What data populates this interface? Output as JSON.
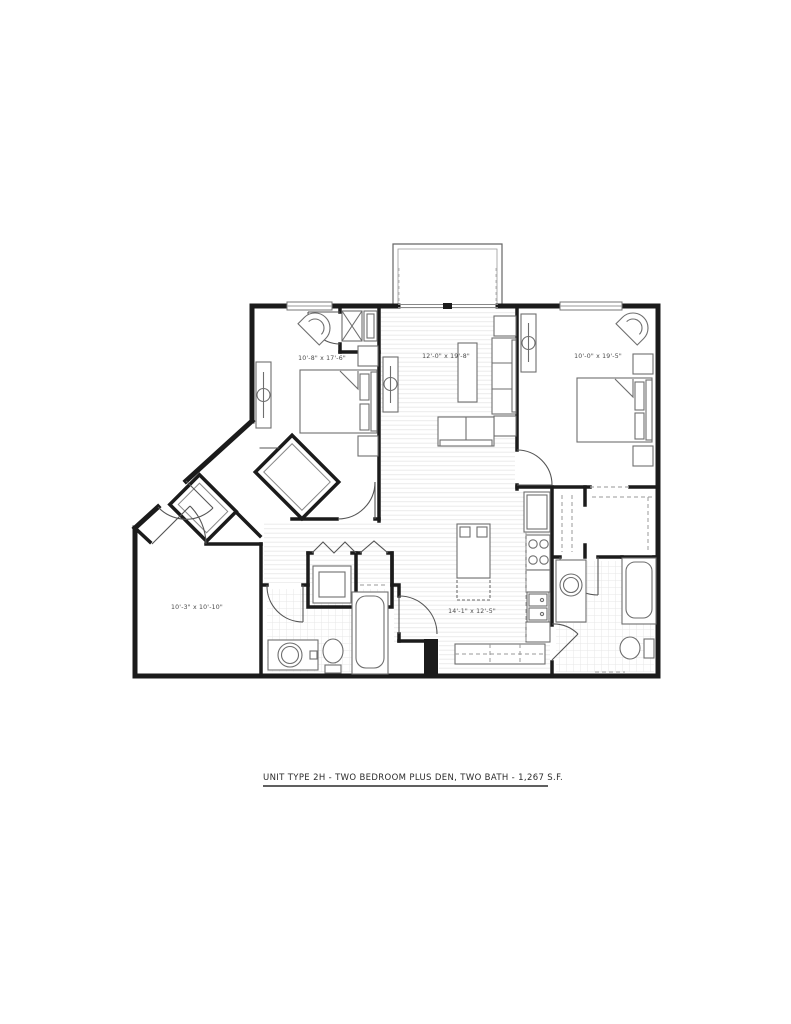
{
  "title": {
    "text": "UNIT TYPE 2H - TWO BEDROOM PLUS DEN, TWO BATH - 1,267 S.F."
  },
  "rooms": {
    "bedroom1": {
      "name": "bedroom-1",
      "dims": "10'-8\" x 17'-6\""
    },
    "living": {
      "name": "living-room",
      "dims": "12'-0\" x 19'-8\""
    },
    "bedroom2": {
      "name": "bedroom-2",
      "dims": "10'-0\" x 19'-5\""
    },
    "kitchen": {
      "name": "kitchen-dining",
      "dims": "14'-1\" x 12'-5\""
    },
    "den": {
      "name": "den",
      "dims": "10'-3\" x 10'-10\""
    }
  },
  "colors": {
    "wall": "#1b1b1b",
    "furniture": "#6e6e6e",
    "door": "#555555",
    "floor_line": "#ebebeb",
    "label": "#4a4a4a"
  }
}
